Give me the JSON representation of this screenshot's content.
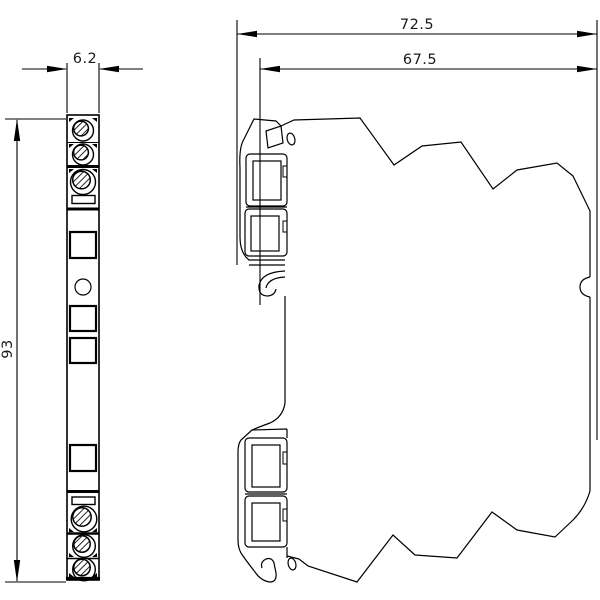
{
  "canvas": {
    "background": "#ffffff",
    "line_color": "#000000"
  },
  "drawing": {
    "kind": "technical-dimension-drawing",
    "dimensions": {
      "front_width": {
        "value": "6.2"
      },
      "front_height": {
        "value": "93"
      },
      "depth_total": {
        "value": "72.5"
      },
      "depth_body": {
        "value": "67.5"
      }
    }
  }
}
